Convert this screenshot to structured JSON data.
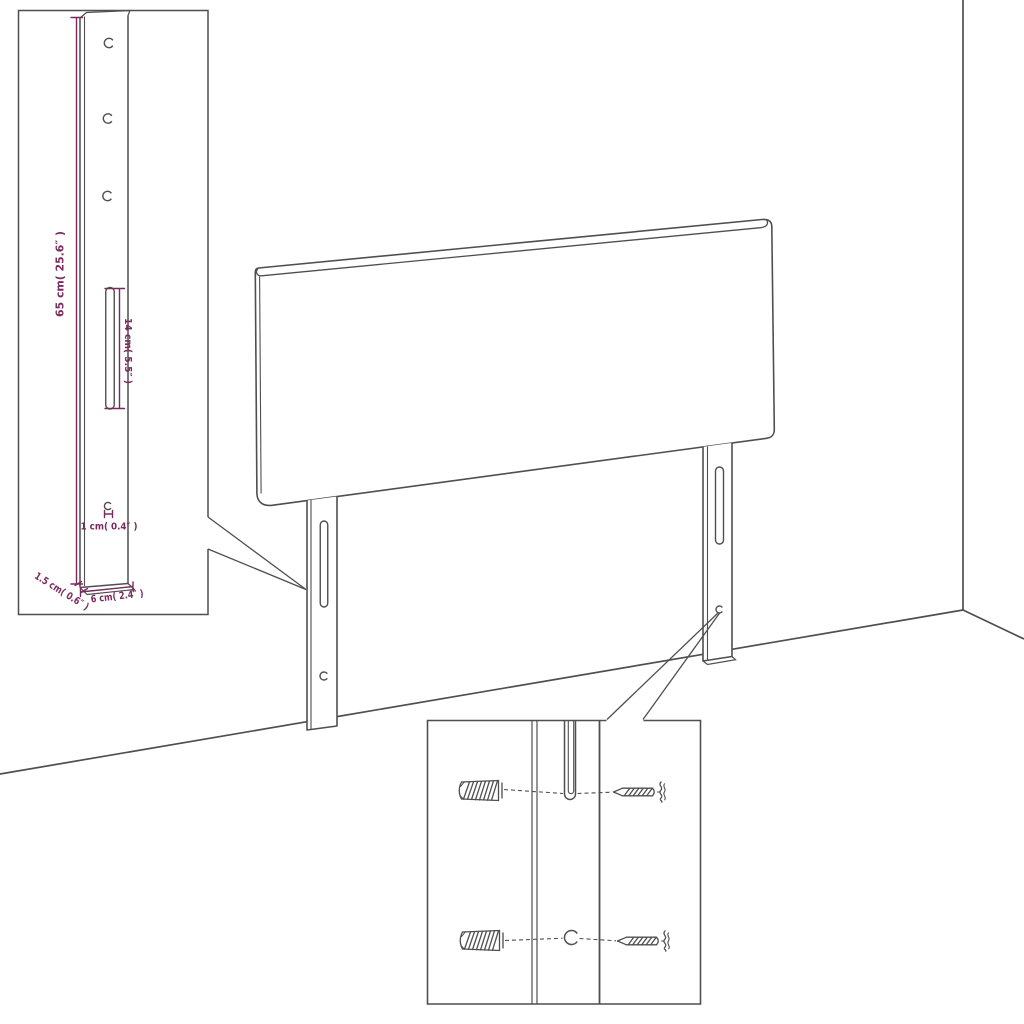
{
  "document": {
    "kind": "furniture assembly dimension diagram",
    "subject": "upholstered headboard with two mounting legs shown in a room corner"
  },
  "colors": {
    "background": "#ffffff",
    "line": "#4f4f4f",
    "dimension": "#7b2a5e"
  },
  "bracket_inset": {
    "dimensions": {
      "height": "65 cm( 25.6″ )",
      "slot_length": "14 cm( 5.5″ )",
      "hole_diameter": "1 cm( 0.4″ )",
      "thickness": "1.5 cm( 0.6″ )",
      "width": "6 cm( 2.4″ )"
    }
  },
  "hardware_inset": {
    "parts": [
      "wall plug",
      "screw",
      "mounting slot",
      "screw hole"
    ]
  },
  "icons": {
    "screw_hole": "open circle with right-side gap",
    "mounting_slot": "vertical capsule outline",
    "wall_plug": "hatched cylinder",
    "screw": "threaded screw pointing left with wavy head"
  }
}
